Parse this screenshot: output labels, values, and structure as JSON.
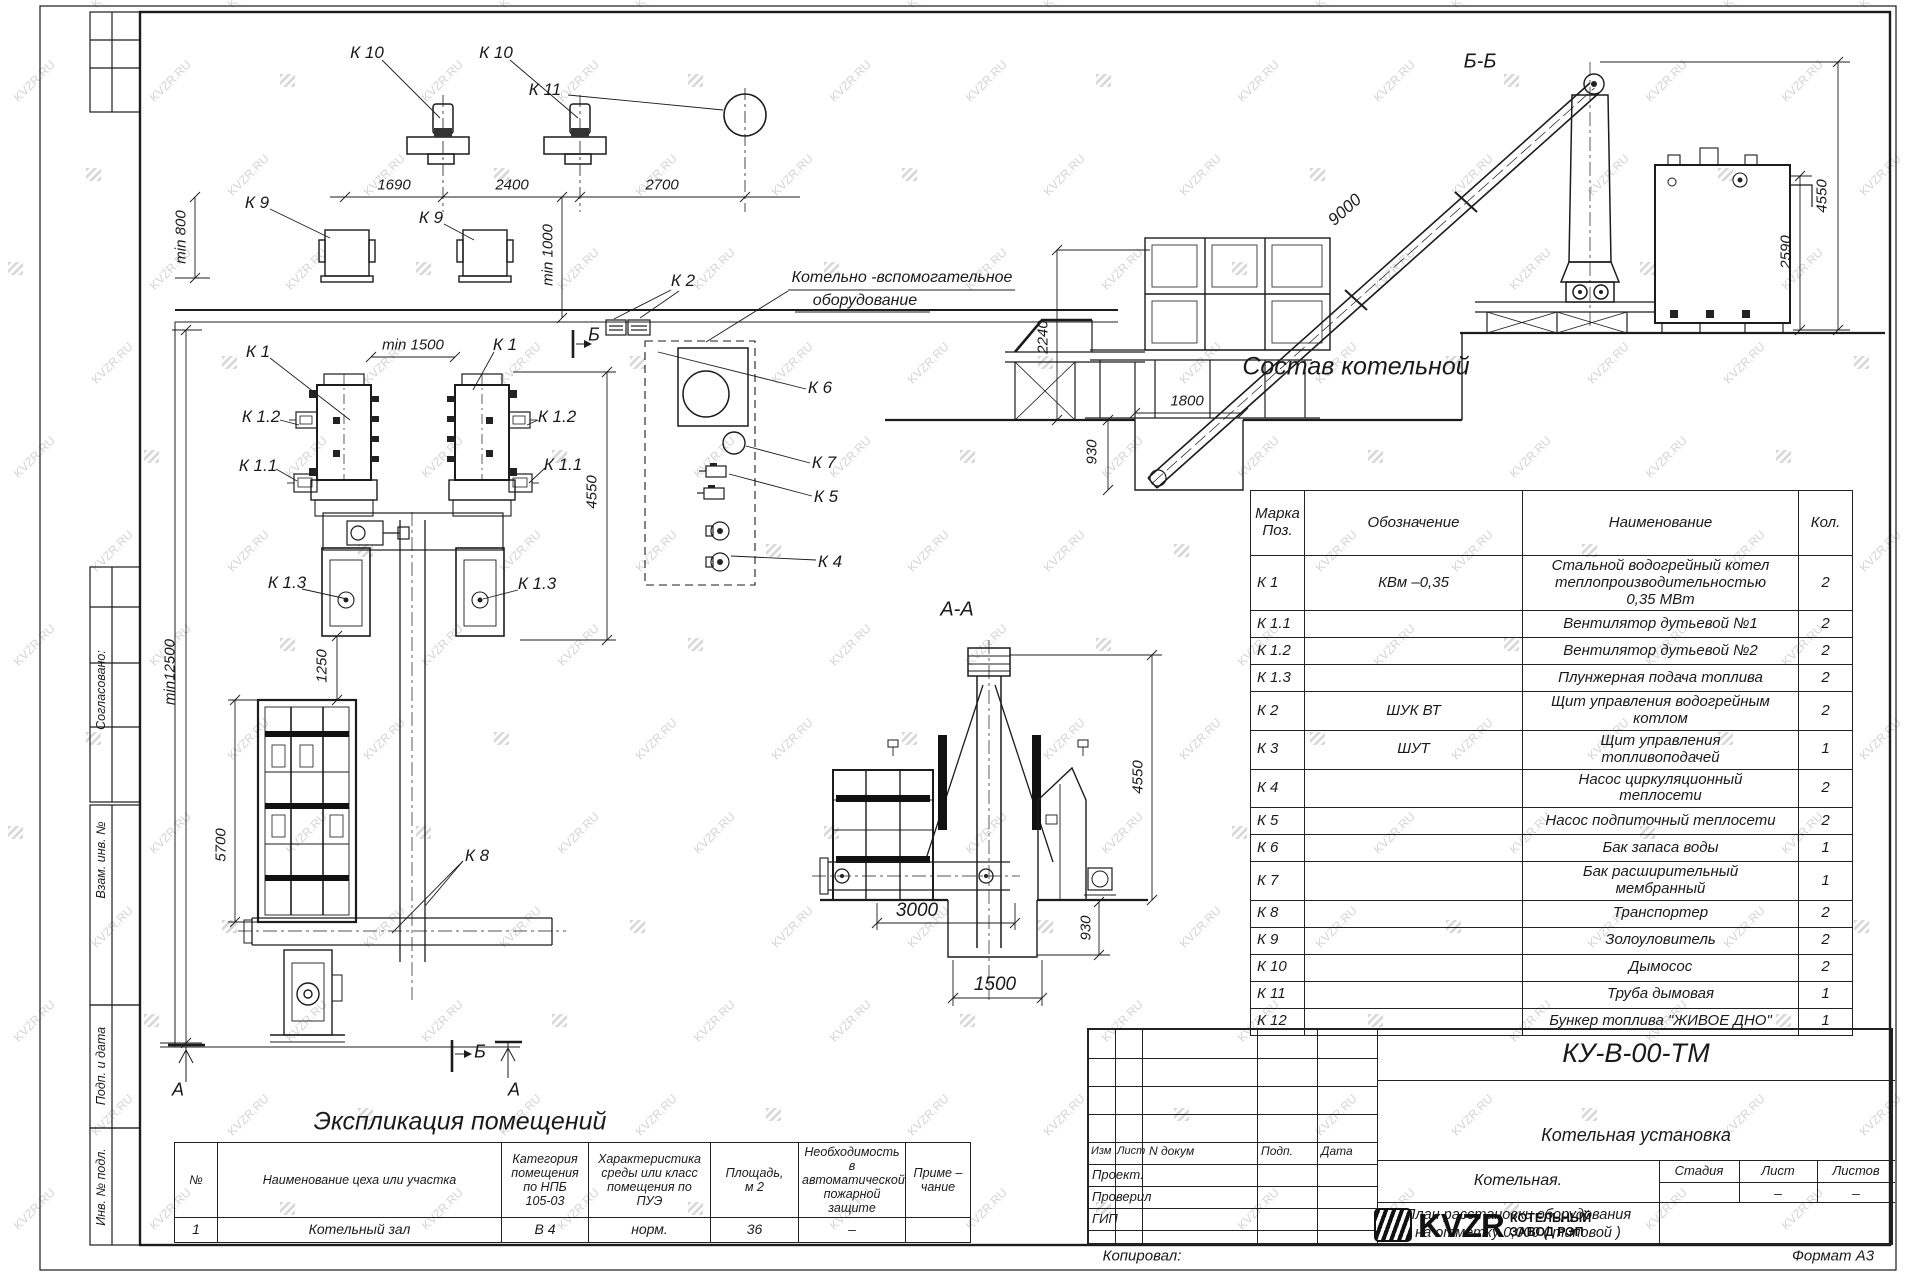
{
  "watermark": {
    "text": "KVZR.RU"
  },
  "sidebar": {
    "agreed": "Согласовано:",
    "vzam": "Взам. инв. №",
    "podp": "Подп. и дата",
    "inv": "Инв. № подл."
  },
  "plan": {
    "k10": "К 10",
    "k9": "К 9",
    "k11": "К 11",
    "k2": "К 2",
    "k1": "К 1",
    "k1_1": "К 1.1",
    "k1_2": "К 1.2",
    "k1_3": "К 1.3",
    "k4": "К 4",
    "k5": "К 5",
    "k6": "К 6",
    "k7": "К 7",
    "k8": "К 8",
    "aux_line1": "Котельно -вспомогательное",
    "aux_line2": "оборудование",
    "dim_1690": "1690",
    "dim_2400": "2400",
    "dim_2700": "2700",
    "dim_min800": "min 800",
    "dim_min1000": "min 1000",
    "dim_min1500": "min 1500",
    "dim_4550": "4550",
    "dim_1250": "1250",
    "dim_min12500": "min12500",
    "dim_5700": "5700",
    "marker_a": "А",
    "marker_b": "Б"
  },
  "section_bb": {
    "title": "Б-Б",
    "dim_9000": "9000",
    "dim_2240": "2240",
    "dim_930": "930",
    "dim_1800": "1800",
    "dim_2590": "2590",
    "dim_4550": "4550"
  },
  "section_aa": {
    "title": "А-А",
    "dim_3000": "3000",
    "dim_1500": "1500",
    "dim_930": "930",
    "dim_4550": "4550"
  },
  "composition": {
    "title": "Состав котельной",
    "headers": [
      "Марка\nПоз.",
      "Обозначение",
      "Наименование",
      "Кол."
    ],
    "rows": [
      [
        "К 1",
        "КВм –0,35",
        "Стальной водогрейный котел\nтеплопроизводительностью\n0,35 МВт",
        "2"
      ],
      [
        "К 1.1",
        "",
        "Вентилятор дутьевой  №1",
        "2"
      ],
      [
        "К 1.2",
        "",
        "Вентилятор дутьевой  №2",
        "2"
      ],
      [
        "К 1.3",
        "",
        "Плунжерная подача топлива",
        "2"
      ],
      [
        "К 2",
        "ШУК ВТ",
        "Щит управления водогрейным\nкотлом",
        "2"
      ],
      [
        "К 3",
        "ШУТ",
        "Щит управления\nтопливоподачей",
        "1"
      ],
      [
        "К 4",
        "",
        "Насос циркуляционный\nтеплосети",
        "2"
      ],
      [
        "К 5",
        "",
        "Насос подпиточный теплосети",
        "2"
      ],
      [
        "К 6",
        "",
        "Бак запаса воды",
        "1"
      ],
      [
        "К 7",
        "",
        "Бак расширительный\nмембранный",
        "1"
      ],
      [
        "К 8",
        "",
        "Транспортер",
        "2"
      ],
      [
        "К 9",
        "",
        "Золоуловитель",
        "2"
      ],
      [
        "К 10",
        "",
        "Дымосос",
        "2"
      ],
      [
        "К 11",
        "",
        "Труба дымовая",
        "1"
      ],
      [
        "К 12",
        "",
        "Бункер топлива  \"ЖИВОЕ ДНО\"",
        "1"
      ]
    ]
  },
  "explication": {
    "title": "Экспликация помещений",
    "headers": [
      "№",
      "Наименование цеха или участка",
      "Категория\nпомещения\nпо НПБ\n105-03",
      "Характеристика\nсреды или класс\nпомещения по\nПУЭ",
      "Площадь,\nм 2",
      "Необходимость в\nавтоматической\nпожарной защите",
      "Приме –\nчание"
    ],
    "rows": [
      [
        "1",
        "Котельный зал",
        "В 4",
        "норм.",
        "36",
        "–",
        ""
      ]
    ]
  },
  "titleblock": {
    "doc_number": "КУ-В-00-ТМ",
    "project": "Котельная установка",
    "object": "Котельная.",
    "sheet_title": "План расстановки оборудования\nна отметку  0,000 ( типовой )",
    "col_izm": "Изм",
    "col_list": "Лист",
    "col_ndok": "N докум",
    "col_podp": "Подп.",
    "col_data": "Дата",
    "role_proekt": "Проект.",
    "role_proveril": "Проверил",
    "role_gip": "ГИП",
    "stage_stadiya": "Стадия",
    "stage_list": "Лист",
    "stage_listov": "Листов",
    "stage_list_value": "–",
    "stage_listov_value": "–",
    "logo_text": "KVZR",
    "company": "КОТЕЛЬНЫЙ\nЗАВОД РЭП",
    "kopiroval": "Копировал:",
    "format": "Формат А3"
  }
}
